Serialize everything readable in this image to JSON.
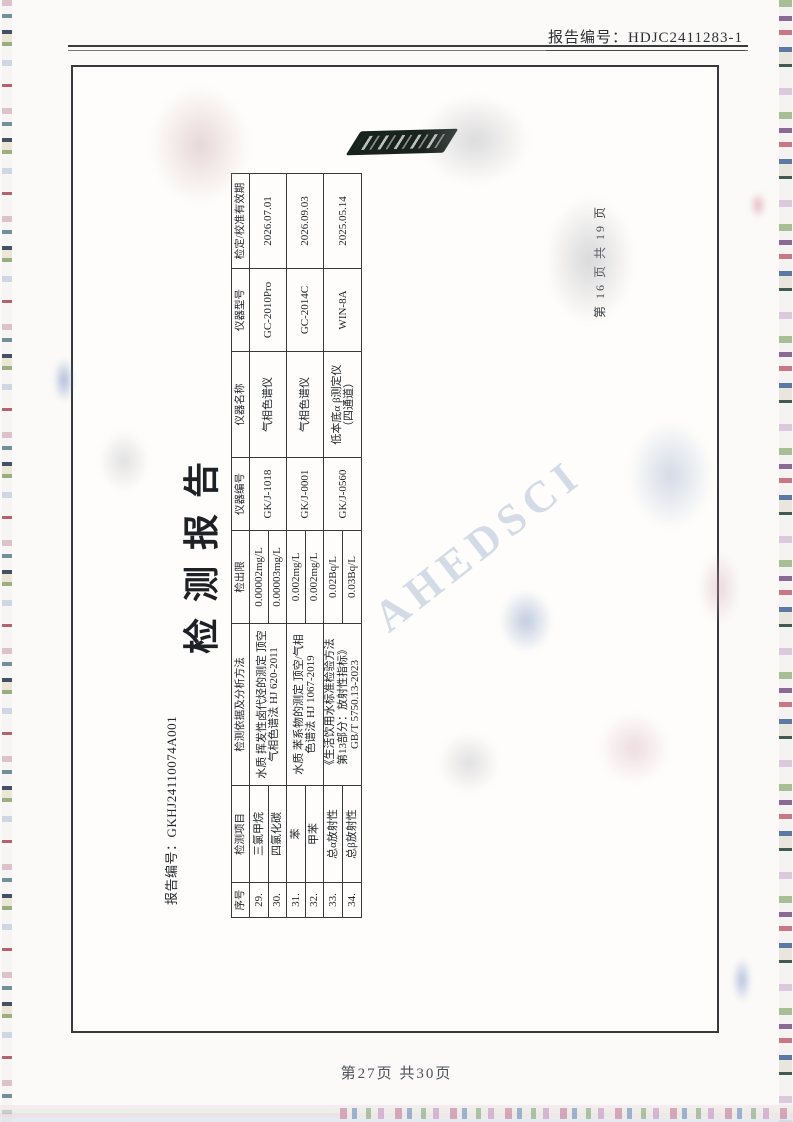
{
  "scan": {
    "header_report_no": "报告编号：HDJC2411283-1",
    "portrait_footer": "第27页  共30页",
    "watermark_text": "AHEDSCI"
  },
  "report": {
    "title": "检测报告",
    "report_no": "报告编号：GKHJ24110074A001",
    "page_note": "第 16 页 共 19 页"
  },
  "table": {
    "headers": [
      "序号",
      "检测项目",
      "检测依据及分析方法",
      "检出限",
      "仪器编号",
      "仪器名称",
      "仪器型号",
      "检定/校准有效期"
    ],
    "rows": [
      {
        "no": "29.",
        "item": "三氯甲烷",
        "limit": "0.00002mg/L"
      },
      {
        "no": "30.",
        "item": "四氯化碳",
        "limit": "0.00003mg/L"
      },
      {
        "no": "31.",
        "item": "苯",
        "limit": "0.002mg/L"
      },
      {
        "no": "32.",
        "item": "甲苯",
        "limit": "0.002mg/L"
      },
      {
        "no": "33.",
        "item": "总α放射性",
        "limit": "0.02Bq/L"
      },
      {
        "no": "34.",
        "item": "总β放射性",
        "limit": "0.03Bq/L"
      }
    ],
    "groups": [
      {
        "method": "水质 挥发性卤代烃的测定 顶空\n气相色谱法 HJ 620-2011",
        "instrument_no": "GK/J-1018",
        "instrument_name": "气相色谱仪",
        "model": "GC-2010Pro",
        "validity": "2026.07.01"
      },
      {
        "method": "水质 苯系物的测定 顶空/气相\n色谱法 HJ 1067-2019",
        "instrument_no": "GK/J-0001",
        "instrument_name": "气相色谱仪",
        "model": "GC-2014C",
        "validity": "2026.09.03"
      },
      {
        "method": "《生活饮用水标准检验方法\n第13部分：放射性指标》\nGB/T 5750.13-2023",
        "instrument_no": "GK/J-0560",
        "instrument_name": "低本底α β测定仪\n（四通道）",
        "model": "WIN-8A",
        "validity": "2025.05.14"
      }
    ],
    "colors": {
      "border": "#37393c",
      "ink": "#1f2428",
      "watermark_blue": "#8ba2c4"
    }
  }
}
